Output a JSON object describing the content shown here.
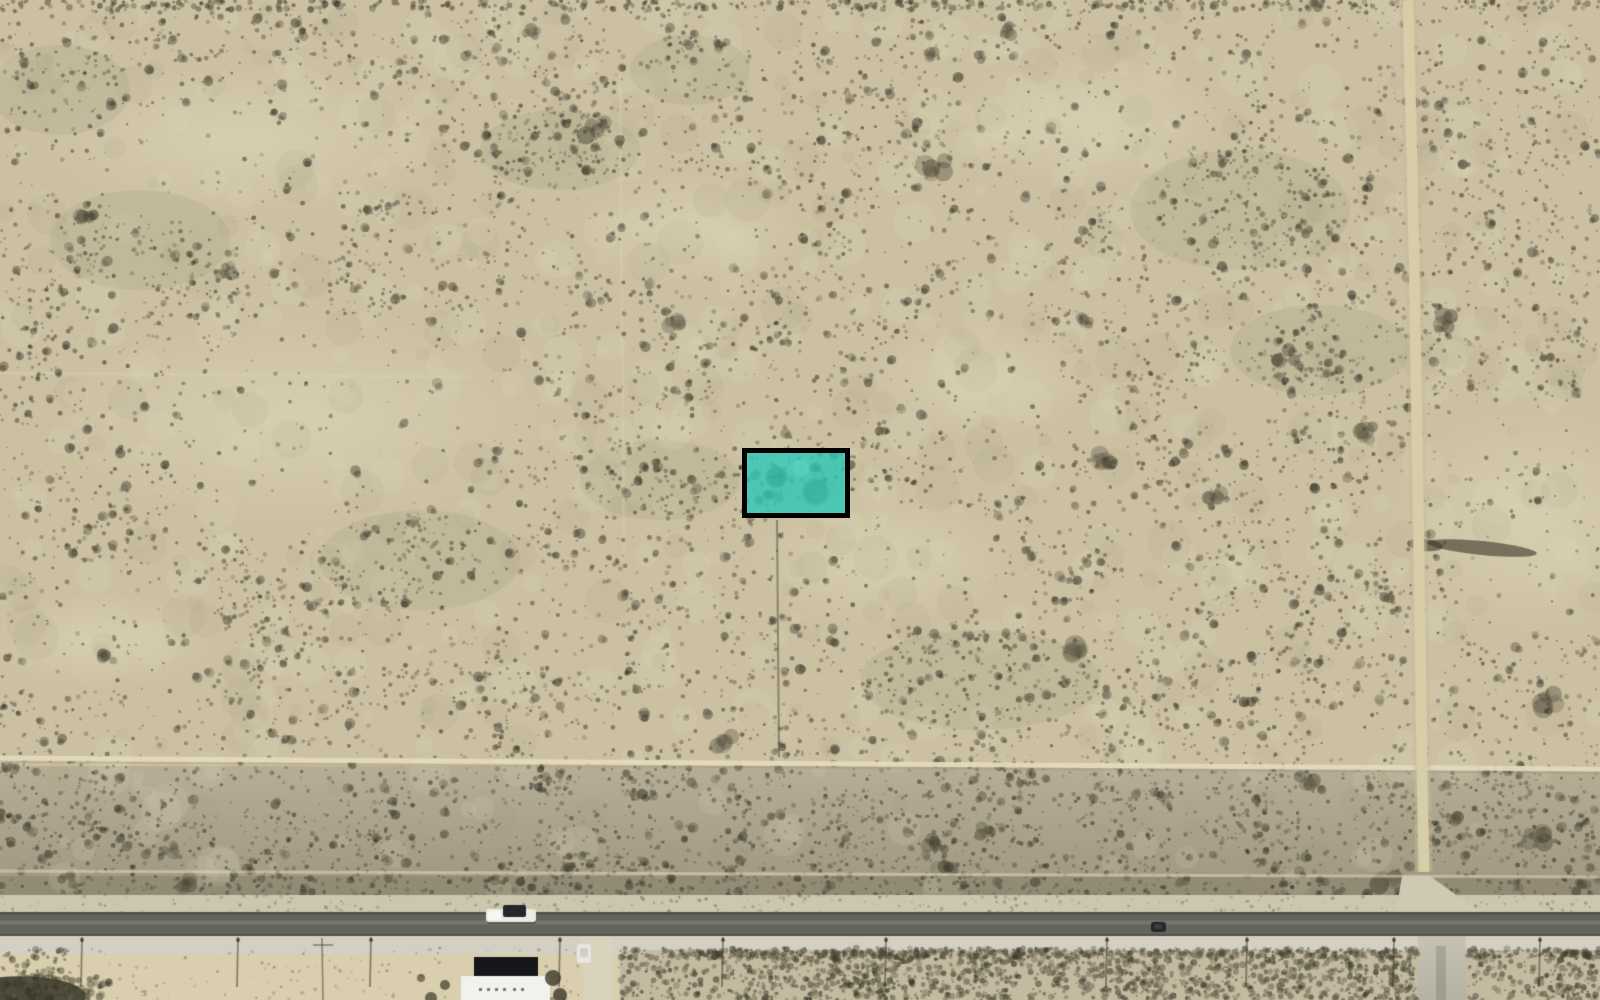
{
  "map": {
    "view": {
      "width": 1600,
      "height": 1000,
      "imagery": "satellite-aerial",
      "scene": "desert scrubland with highlighted survey parcel, paved road and dirt roads"
    },
    "palette": {
      "sand_base": "#cbc0a2",
      "sand_light": "#ded4b2",
      "band_base": "#b7ae96",
      "fringe_base": "#a59e87",
      "bush_dark": "#423e2e",
      "shoulder_north": "#cdc6ae",
      "asphalt": "#63655c",
      "asphalt_edge": "#4f514a",
      "asphalt_center": "#6e7066",
      "shoulder_south": "#d3d0c3",
      "south_sand": "#d9cfae",
      "south_veg": "#c3baa0",
      "dirt_road": "#d7cda9",
      "dirt_track": "#e2d8b6",
      "road_continuation": "#b6b2a4",
      "driveway": "#d9d3bd",
      "building_white": "#f2f1ec",
      "building_dark": "#15161a",
      "vehicle_white": "#eceae2",
      "vehicle_dark": "#23262a"
    },
    "parcel_highlight": {
      "x": 742,
      "y": 448,
      "width": 108,
      "height": 70,
      "fill": "#2cc8b6",
      "fill_opacity": 0.8,
      "border_color": "#000000",
      "border_width": 5
    },
    "paved_road": {
      "orientation": "horizontal",
      "asphalt_top": 912,
      "asphalt_bottom": 936,
      "shoulder_north_top": 895,
      "shoulder_south_bottom": 954
    },
    "dirt_road_vertical": {
      "points": [
        [
          1408,
          0
        ],
        [
          1414,
          250
        ],
        [
          1419,
          560
        ],
        [
          1422,
          770
        ],
        [
          1424,
          872
        ]
      ],
      "width": 11
    },
    "dirt_track_horizontal": {
      "main_y_left": 758,
      "main_y_right": 769,
      "second_y_left": 871,
      "second_y_right": 877
    },
    "veg_band": {
      "y_top": 766,
      "y_bottom": 895
    },
    "old_tracks": {
      "horizontal_y": 373,
      "horizontal_x_end": 470,
      "vertical_x": 620,
      "vertical_y1": 70,
      "vertical_y2": 560
    },
    "fence_line_mid": {
      "x": 777,
      "y1": 520,
      "y2": 757
    },
    "intersection": {
      "polygon": [
        [
          1402,
          876
        ],
        [
          1430,
          876
        ],
        [
          1480,
          912
        ],
        [
          1480,
          936
        ],
        [
          1390,
          936
        ],
        [
          1396,
          912
        ]
      ]
    },
    "road_continuation": {
      "x": 1418,
      "width": 48,
      "y_top": 936,
      "y_bottom": 1000
    },
    "building": {
      "dark_roof": [
        474,
        957,
        64,
        20
      ],
      "white_roof": [
        461,
        976,
        89,
        24
      ],
      "roof_marks_y": 988,
      "roof_marks_x": [
        479,
        487,
        495,
        503,
        513,
        521
      ]
    },
    "driveway": {
      "x": 583,
      "width": 30,
      "y_top": 936,
      "y_bottom": 1000
    },
    "vehicles": [
      {
        "kind": "pickup-truck-with-trailer",
        "x": 486,
        "y": 905
      },
      {
        "kind": "dark-car",
        "x": 1151,
        "y": 922
      },
      {
        "kind": "white-car-parked",
        "x": 577,
        "y": 944
      }
    ],
    "utility_poles": {
      "x_positions": [
        82,
        238,
        371,
        560,
        723,
        886,
        1107,
        1247,
        1394,
        1540
      ],
      "y_top": 937,
      "y_bottom": 987
    },
    "fences_south": [
      {
        "x": 322,
        "y1": 938,
        "y2": 1000
      }
    ],
    "south_regions": {
      "veg_x_ranges": [
        [
          620,
          1418
        ],
        [
          1466,
          1600
        ]
      ],
      "sand_x_range": [
        70,
        583
      ],
      "dark_corner_x_range": [
        0,
        70
      ]
    },
    "light_patches": [
      [
        240,
        140,
        210,
        80
      ],
      [
        690,
        230,
        120,
        60
      ],
      [
        1090,
        120,
        140,
        70
      ],
      [
        300,
        420,
        260,
        110
      ],
      [
        880,
        560,
        140,
        70
      ],
      [
        1530,
        520,
        150,
        120
      ],
      [
        980,
        380,
        120,
        60
      ],
      [
        100,
        640,
        120,
        50
      ]
    ],
    "dense_patches": [
      [
        140,
        240,
        90,
        50
      ],
      [
        560,
        150,
        80,
        40
      ],
      [
        1240,
        210,
        110,
        60
      ],
      [
        420,
        560,
        100,
        50
      ],
      [
        980,
        680,
        120,
        50
      ],
      [
        1320,
        350,
        90,
        45
      ],
      [
        660,
        480,
        80,
        40
      ],
      [
        60,
        90,
        70,
        45
      ],
      [
        690,
        70,
        60,
        35
      ]
    ],
    "dark_streaks": [
      [
        1482,
        548,
        55,
        7
      ],
      [
        1425,
        545,
        18,
        6
      ]
    ]
  }
}
